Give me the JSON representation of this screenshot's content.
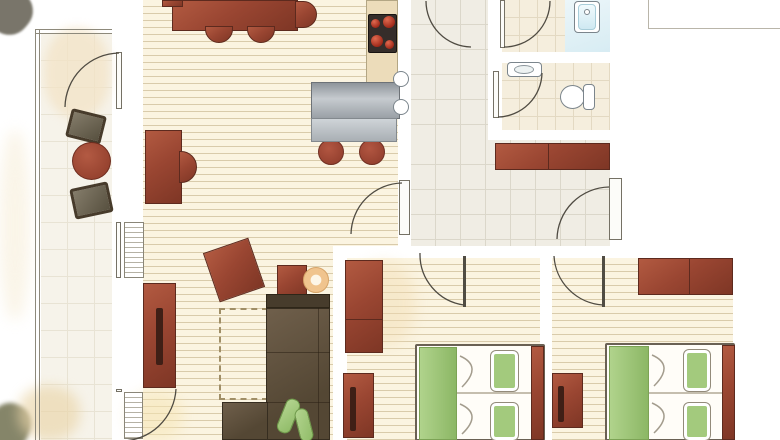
{
  "canvas": {
    "w": 780,
    "h": 440
  },
  "palette": {
    "wall": "#9e9a8d",
    "floor_wood": "#fbf4e1",
    "floor_tile_hall": "#f0ede4",
    "floor_tile_bath": "#f5eedd",
    "furniture_red": "#9a4632",
    "sofa_brown": "#5f5140",
    "bed_green": "#a3ca7d",
    "water_blue": "#d9edf4",
    "counter_steel": "#b6bbc0",
    "counter_tan": "#ecdcba",
    "side_table_tan": "#f0c48e",
    "terrace_chair_gray": "#6f6757"
  },
  "scene": {
    "floors": [
      {
        "n": "living-room-floor",
        "c": "plank",
        "x": 143,
        "y": 0,
        "w": 255,
        "h": 246
      },
      {
        "n": "living-room-floor-lower",
        "c": "plank",
        "x": 143,
        "y": 246,
        "w": 190,
        "h": 194
      },
      {
        "n": "bedroom1-floor",
        "c": "plank",
        "x": 347,
        "y": 258,
        "w": 193,
        "h": 182
      },
      {
        "n": "bedroom2-floor",
        "c": "plank",
        "x": 552,
        "y": 258,
        "w": 181,
        "h": 182
      },
      {
        "n": "vestibule-floor",
        "c": "tile-hall",
        "x": 411,
        "y": 0,
        "w": 77,
        "h": 140
      },
      {
        "n": "hall-floor",
        "c": "tile-hall",
        "x": 411,
        "y": 140,
        "w": 199,
        "h": 106
      },
      {
        "n": "bathroom-floor",
        "c": "tile-bath",
        "x": 502,
        "y": 0,
        "w": 108,
        "h": 52
      },
      {
        "n": "bathroom-wet-zone",
        "c": "wet",
        "x": 565,
        "y": 0,
        "w": 45,
        "h": 52
      },
      {
        "n": "wc-floor",
        "c": "tile-bath",
        "x": 502,
        "y": 63,
        "w": 108,
        "h": 67
      },
      {
        "n": "terrace-floor",
        "c": "terrace-floor",
        "x": 41,
        "y": 34,
        "w": 71,
        "h": 406
      }
    ],
    "washes": [
      {
        "n": "corner-bush-wash",
        "c": "wash",
        "x": -14,
        "y": -12,
        "w": 46,
        "h": 46,
        "f": "#6b675a",
        "o": 0.9,
        "r": 40,
        "b": 1
      },
      {
        "n": "terrace-wash",
        "c": "wash",
        "x": 44,
        "y": 28,
        "w": 66,
        "h": 90,
        "f": "#f3e3c6",
        "o": 0.75,
        "b": 5
      },
      {
        "n": "left-edge-wash",
        "c": "wash",
        "x": 0,
        "y": 130,
        "w": 30,
        "h": 190,
        "f": "#f7eed9",
        "o": 0.6,
        "b": 7
      },
      {
        "n": "bottom-left-olive-wash",
        "c": "wash",
        "x": -12,
        "y": 403,
        "w": 42,
        "h": 48,
        "f": "#70704f",
        "o": 0.85,
        "r": 25,
        "b": 2
      },
      {
        "n": "bottom-left-tan-wash",
        "c": "wash",
        "x": 18,
        "y": 386,
        "w": 62,
        "h": 54,
        "f": "#ead5a9",
        "o": 0.65,
        "b": 6
      },
      {
        "n": "living-door-wash",
        "c": "wash",
        "x": 128,
        "y": 392,
        "w": 55,
        "h": 48,
        "f": "#f6e5b4",
        "o": 0.55,
        "b": 7
      },
      {
        "n": "bedroom1-wash",
        "c": "wash",
        "x": 350,
        "y": 262,
        "w": 66,
        "h": 84,
        "f": "#f2dcb2",
        "o": 0.45,
        "b": 7
      },
      {
        "n": "bedroom2-wash",
        "c": "wash",
        "x": 628,
        "y": 412,
        "w": 45,
        "h": 26,
        "f": "#f0ddb5",
        "o": 0.5,
        "b": 6
      }
    ],
    "walls": [
      {
        "n": "wall-terrace-upper",
        "x": 112,
        "y": 0,
        "w": 31,
        "h": 53
      },
      {
        "n": "wall-terrace-mid",
        "x": 112,
        "y": 110,
        "w": 31,
        "h": 112
      },
      {
        "n": "wall-terrace-lower",
        "x": 112,
        "y": 280,
        "w": 31,
        "h": 109
      },
      {
        "n": "wall-terrace-bottom",
        "x": 112,
        "y": 437,
        "w": 31,
        "h": 3
      },
      {
        "n": "wall-kitchen-hall",
        "x": 398,
        "y": 0,
        "w": 13,
        "h": 178
      },
      {
        "n": "wall-kitchen-hall-lower",
        "x": 398,
        "y": 235,
        "w": 13,
        "h": 23
      },
      {
        "n": "wall-main-a",
        "x": 333,
        "y": 246,
        "w": 85,
        "h": 12
      },
      {
        "n": "wall-main-b",
        "x": 467,
        "y": 246,
        "w": 84,
        "h": 12
      },
      {
        "n": "wall-main-c",
        "x": 605,
        "y": 246,
        "w": 140,
        "h": 12
      },
      {
        "n": "wall-bedroom1-left",
        "x": 333,
        "y": 252,
        "w": 14,
        "h": 188
      },
      {
        "n": "wall-bedrooms-divider",
        "x": 540,
        "y": 252,
        "w": 12,
        "h": 188
      },
      {
        "n": "wall-right-upper",
        "x": 610,
        "y": 0,
        "w": 13,
        "h": 178
      },
      {
        "n": "wall-right-stub",
        "x": 610,
        "y": 240,
        "w": 13,
        "h": 7
      },
      {
        "n": "wall-bedroom2-right",
        "x": 733,
        "y": 246,
        "w": 12,
        "h": 194
      },
      {
        "n": "wall-bath-left-a",
        "x": 488,
        "y": 48,
        "w": 14,
        "h": 23
      },
      {
        "n": "wall-bath-left-b",
        "x": 488,
        "y": 117,
        "w": 14,
        "h": 23
      },
      {
        "n": "wall-bath-divider",
        "x": 500,
        "y": 52,
        "w": 110,
        "h": 11
      },
      {
        "n": "wall-wc-bottom",
        "x": 488,
        "y": 130,
        "w": 122,
        "h": 10
      },
      {
        "n": "kitchen-sink-stub",
        "x": 388,
        "y": 65,
        "w": 11,
        "h": 53
      }
    ],
    "lines": [
      {
        "n": "terrace-rail-left-outer",
        "x": 35,
        "y": 29,
        "w": 1,
        "h": 411,
        "f": "#8d897b"
      },
      {
        "n": "terrace-rail-left-inner",
        "x": 39,
        "y": 29,
        "w": 1,
        "h": 411,
        "f": "#8d897b"
      },
      {
        "n": "terrace-rail-top-outer",
        "x": 35,
        "y": 29,
        "w": 77,
        "h": 1,
        "f": "#8d897b"
      },
      {
        "n": "terrace-rail-top-inner",
        "x": 35,
        "y": 33,
        "w": 77,
        "h": 1,
        "f": "#8d897b"
      },
      {
        "n": "exterior-line-vertical",
        "x": 648,
        "y": 0,
        "w": 1,
        "h": 29,
        "f": "#b9b5a9"
      },
      {
        "n": "exterior-line-horizontal",
        "x": 648,
        "y": 28,
        "w": 132,
        "h": 1,
        "f": "#b9b5a9"
      }
    ],
    "furniture": [
      {
        "n": "dining-table",
        "c": "red3d",
        "x": 172,
        "y": 0,
        "w": 126,
        "h": 31
      },
      {
        "n": "dining-chair-left-stub",
        "c": "red3d",
        "x": 162,
        "y": 0,
        "w": 21,
        "h": 7
      },
      {
        "n": "dining-chair-right",
        "c": "red3d chair-right",
        "x": 295,
        "y": 1,
        "w": 22,
        "h": 27
      },
      {
        "n": "dining-chair-1",
        "c": "red3d chair-down",
        "x": 205,
        "y": 26,
        "w": 28,
        "h": 17
      },
      {
        "n": "dining-chair-2",
        "c": "red3d chair-down",
        "x": 247,
        "y": 26,
        "w": 28,
        "h": 17
      },
      {
        "n": "kitchen-tall-counter",
        "c": "tan",
        "x": 366,
        "y": 0,
        "w": 32,
        "h": 83
      },
      {
        "n": "stove",
        "c": "stove",
        "x": 368,
        "y": 14,
        "w": 29,
        "h": 39
      },
      {
        "n": "stove-burner-1",
        "c": "burner",
        "x": 371,
        "y": 19,
        "w": 9,
        "h": 9
      },
      {
        "n": "stove-burner-2",
        "c": "burner",
        "x": 383,
        "y": 16,
        "w": 12,
        "h": 12
      },
      {
        "n": "stove-burner-3",
        "c": "burner",
        "x": 371,
        "y": 35,
        "w": 12,
        "h": 12
      },
      {
        "n": "stove-burner-4",
        "c": "burner",
        "x": 385,
        "y": 40,
        "w": 9,
        "h": 9
      },
      {
        "n": "bar-stool-1",
        "c": "stool",
        "x": 318,
        "y": 139,
        "w": 26,
        "h": 26
      },
      {
        "n": "bar-stool-2",
        "c": "stool",
        "x": 359,
        "y": 139,
        "w": 26,
        "h": 26
      },
      {
        "n": "bar-counter",
        "c": "steel",
        "x": 311,
        "y": 82,
        "w": 89,
        "h": 37
      },
      {
        "n": "bar-table",
        "c": "steel-light",
        "x": 311,
        "y": 118,
        "w": 86,
        "h": 24
      },
      {
        "n": "desk",
        "c": "red3d",
        "x": 145,
        "y": 130,
        "w": 37,
        "h": 74
      },
      {
        "n": "desk-chair",
        "c": "red3d chair-right",
        "x": 179,
        "y": 151,
        "w": 18,
        "h": 32
      },
      {
        "n": "living-sideboard",
        "c": "red3d",
        "x": 143,
        "y": 283,
        "w": 33,
        "h": 105
      },
      {
        "n": "living-sideboard-handle",
        "c": "slot",
        "x": 156,
        "y": 308,
        "w": 7,
        "h": 57
      },
      {
        "n": "armchair-rotated",
        "c": "red3d",
        "x": 210,
        "y": 244,
        "w": 48,
        "h": 52,
        "r": -19
      },
      {
        "n": "armchair-small",
        "c": "red3d",
        "x": 277,
        "y": 265,
        "w": 30,
        "h": 33
      },
      {
        "n": "side-table-round",
        "c": "donut",
        "x": 303,
        "y": 267,
        "w": 26,
        "h": 26
      },
      {
        "n": "rug-dashed-outline",
        "c": "rug",
        "x": 219,
        "y": 308,
        "w": 49,
        "h": 92
      },
      {
        "n": "sofa-back",
        "c": "sofa-dark",
        "x": 266,
        "y": 294,
        "w": 64,
        "h": 14
      },
      {
        "n": "sofa-main",
        "c": "sofa",
        "x": 266,
        "y": 308,
        "w": 64,
        "h": 132
      },
      {
        "n": "sofa-chaise",
        "c": "sofa",
        "x": 222,
        "y": 402,
        "w": 46,
        "h": 38
      },
      {
        "n": "sofa-seam-1",
        "x": 266,
        "y": 352,
        "w": 64,
        "h": 1,
        "f": "rgba(40,30,18,0.5)"
      },
      {
        "n": "sofa-seam-2",
        "x": 266,
        "y": 402,
        "w": 64,
        "h": 1,
        "f": "rgba(40,30,18,0.5)"
      },
      {
        "n": "sofa-seam-vertical",
        "x": 318,
        "y": 308,
        "w": 1,
        "h": 132,
        "f": "rgba(40,30,18,0.5)"
      },
      {
        "n": "sofa-cushion-1",
        "c": "green-pillow",
        "x": 281,
        "y": 398,
        "w": 15,
        "h": 36,
        "r": 22
      },
      {
        "n": "sofa-cushion-2",
        "c": "green-pillow",
        "x": 297,
        "y": 408,
        "w": 14,
        "h": 34,
        "r": -14
      },
      {
        "n": "hall-sideboard",
        "c": "red3d",
        "x": 495,
        "y": 143,
        "w": 115,
        "h": 27
      },
      {
        "n": "hall-sideboard-seam",
        "x": 548,
        "y": 143,
        "w": 1,
        "h": 27,
        "f": "#5d2a1e"
      },
      {
        "n": "bedroom1-wardrobe",
        "c": "red3d",
        "x": 345,
        "y": 260,
        "w": 38,
        "h": 93
      },
      {
        "n": "bedroom1-wardrobe-seam",
        "x": 345,
        "y": 319,
        "w": 38,
        "h": 1,
        "f": "#5d2a1e"
      },
      {
        "n": "bedroom1-dresser",
        "c": "red3d",
        "x": 343,
        "y": 373,
        "w": 31,
        "h": 65
      },
      {
        "n": "bedroom1-dresser-handle",
        "c": "slot",
        "x": 350,
        "y": 387,
        "w": 6,
        "h": 44
      },
      {
        "n": "bedroom1-bed",
        "c": "bed",
        "x": 415,
        "y": 344,
        "w": 130,
        "h": 97
      },
      {
        "n": "bedroom1-bed-sheet",
        "c": "green-sheet",
        "x": 419,
        "y": 347,
        "w": 38,
        "h": 93
      },
      {
        "n": "bedroom1-duvet-seam",
        "x": 457,
        "y": 392,
        "w": 74,
        "h": 2,
        "f": "#c5beae"
      },
      {
        "n": "bedroom1-pillow-1",
        "c": "pillow",
        "x": 491,
        "y": 351,
        "w": 27,
        "h": 40
      },
      {
        "n": "bedroom1-pillow-2",
        "c": "pillow",
        "x": 491,
        "y": 403,
        "w": 27,
        "h": 37
      },
      {
        "n": "bedroom1-headboard",
        "c": "red3d",
        "x": 531,
        "y": 346,
        "w": 13,
        "h": 94
      },
      {
        "n": "bedroom2-wardrobe",
        "c": "red3d",
        "x": 638,
        "y": 258,
        "w": 95,
        "h": 37
      },
      {
        "n": "bedroom2-wardrobe-seam",
        "x": 689,
        "y": 258,
        "w": 1,
        "h": 37,
        "f": "#5d2a1e"
      },
      {
        "n": "bedroom2-dresser",
        "c": "red3d",
        "x": 552,
        "y": 373,
        "w": 31,
        "h": 55
      },
      {
        "n": "bedroom2-dresser-handle",
        "c": "slot",
        "x": 558,
        "y": 386,
        "w": 6,
        "h": 36
      },
      {
        "n": "bedroom2-bed",
        "c": "bed",
        "x": 605,
        "y": 343,
        "w": 130,
        "h": 98
      },
      {
        "n": "bedroom2-bed-sheet",
        "c": "green-sheet",
        "x": 609,
        "y": 346,
        "w": 40,
        "h": 94
      },
      {
        "n": "bedroom2-duvet-seam",
        "x": 649,
        "y": 392,
        "w": 73,
        "h": 2,
        "f": "#c5beae"
      },
      {
        "n": "bedroom2-pillow-1",
        "c": "pillow",
        "x": 684,
        "y": 350,
        "w": 26,
        "h": 41
      },
      {
        "n": "bedroom2-pillow-2",
        "c": "pillow",
        "x": 684,
        "y": 403,
        "w": 26,
        "h": 37
      },
      {
        "n": "bedroom2-headboard",
        "c": "red3d",
        "x": 722,
        "y": 345,
        "w": 13,
        "h": 95
      },
      {
        "n": "terrace-chair-1",
        "c": "tchair",
        "x": 68,
        "y": 112,
        "w": 36,
        "h": 29,
        "r": 14
      },
      {
        "n": "terrace-table-round",
        "c": "tround",
        "x": 72,
        "y": 142,
        "w": 39,
        "h": 38
      },
      {
        "n": "terrace-chair-2",
        "c": "tchair",
        "x": 72,
        "y": 185,
        "w": 39,
        "h": 31,
        "r": -12
      }
    ],
    "fixtures": [
      {
        "n": "window-radiator",
        "c": "radiator",
        "x": 124,
        "y": 222,
        "w": 20,
        "h": 56
      },
      {
        "n": "window-glass",
        "c": "leaf-white",
        "x": 116,
        "y": 222,
        "w": 5,
        "h": 56
      },
      {
        "n": "terrace-door2-radiator",
        "c": "radiator",
        "x": 124,
        "y": 392,
        "w": 19,
        "h": 47
      },
      {
        "n": "kitchen-sink-bowl-1",
        "c": "white-fix circle",
        "x": 393,
        "y": 71,
        "w": 16,
        "h": 16
      },
      {
        "n": "kitchen-sink-bowl-2",
        "c": "white-fix circle",
        "x": 393,
        "y": 99,
        "w": 16,
        "h": 16
      },
      {
        "n": "bathtub",
        "c": "white-fix",
        "x": 574,
        "y": 1,
        "w": 26,
        "h": 32
      },
      {
        "n": "bathtub-water",
        "c": "tubwater",
        "x": 578,
        "y": 4,
        "w": 18,
        "h": 26
      },
      {
        "n": "bathtub-drain",
        "c": "white-fix circle",
        "x": 584,
        "y": 9,
        "w": 6,
        "h": 6
      },
      {
        "n": "washbasin",
        "c": "white-fix",
        "x": 507,
        "y": 62,
        "w": 35,
        "h": 15
      },
      {
        "n": "washbasin-bowl",
        "c": "bowl",
        "x": 514,
        "y": 65,
        "w": 20,
        "h": 9
      },
      {
        "n": "toilet-bowl",
        "c": "white-fix circle",
        "x": 560,
        "y": 85,
        "w": 25,
        "h": 24
      },
      {
        "n": "toilet-tank",
        "c": "white-fix",
        "x": 583,
        "y": 84,
        "w": 12,
        "h": 26
      }
    ],
    "leaves": [
      {
        "n": "terrace-door-leaf",
        "c": "leaf-white",
        "x": 116,
        "y": 52,
        "w": 6,
        "h": 57
      },
      {
        "n": "living-terrace-door2-leaf",
        "c": "leaf-white",
        "x": 116,
        "y": 389,
        "w": 6,
        "h": 3
      },
      {
        "n": "living-hall-door-leaf",
        "c": "leaf-white",
        "x": 399,
        "y": 180,
        "w": 11,
        "h": 55
      },
      {
        "n": "entry-door-leaf",
        "c": "leaf-white",
        "x": 609,
        "y": 178,
        "w": 13,
        "h": 62
      },
      {
        "n": "bathroom-door-leaf",
        "c": "leaf-white",
        "x": 500,
        "y": 0,
        "w": 5,
        "h": 48
      },
      {
        "n": "wc-door-leaf",
        "c": "leaf-white",
        "x": 493,
        "y": 71,
        "w": 6,
        "h": 47
      },
      {
        "n": "bedroom1-door-leaf",
        "c": "leaf-dark",
        "x": 463,
        "y": 256,
        "w": 3,
        "h": 51
      },
      {
        "n": "bedroom2-door-leaf",
        "c": "leaf-dark",
        "x": 602,
        "y": 256,
        "w": 3,
        "h": 51
      }
    ],
    "arcs": [
      {
        "n": "terrace-door-arc",
        "c": "arc",
        "d": "M 65 107 A 55 55 0 0 1 119 53"
      },
      {
        "n": "living-terrace-door2-arc",
        "c": "arc",
        "d": "M 176 389 A 55 55 0 0 1 121 441"
      },
      {
        "n": "living-hall-door-arc",
        "c": "arc",
        "d": "M 351 234 A 52 52 0 0 1 402 183"
      },
      {
        "n": "vestibule-door-arc",
        "c": "arc",
        "d": "M 426 1 A 46 46 0 0 0 471 47"
      },
      {
        "n": "bathroom-door-arc",
        "c": "arc",
        "d": "M 504 47 A 46 46 0 0 0 550 1"
      },
      {
        "n": "wc-door-arc",
        "c": "arc",
        "d": "M 498 117 A 45 45 0 0 0 542 73"
      },
      {
        "n": "entry-door-arc",
        "c": "arc",
        "d": "M 557 239 A 53 53 0 0 1 609 187"
      },
      {
        "n": "bedroom1-door-arc",
        "c": "arc",
        "d": "M 420 253 A 51 51 0 0 0 464 305"
      },
      {
        "n": "bedroom2-door-arc",
        "c": "arc",
        "d": "M 554 256 A 52 52 0 0 0 603 305"
      },
      {
        "n": "bed1-duvet-fold-1",
        "c": "fold",
        "d": "M 460 356 Q 483 366 462 387"
      },
      {
        "n": "bed1-duvet-fold-2",
        "c": "fold",
        "d": "M 460 404 Q 483 414 462 434"
      },
      {
        "n": "bed2-duvet-fold-1",
        "c": "fold",
        "d": "M 652 355 Q 675 365 654 386"
      },
      {
        "n": "bed2-duvet-fold-2",
        "c": "fold",
        "d": "M 652 403 Q 675 413 654 433"
      }
    ]
  }
}
